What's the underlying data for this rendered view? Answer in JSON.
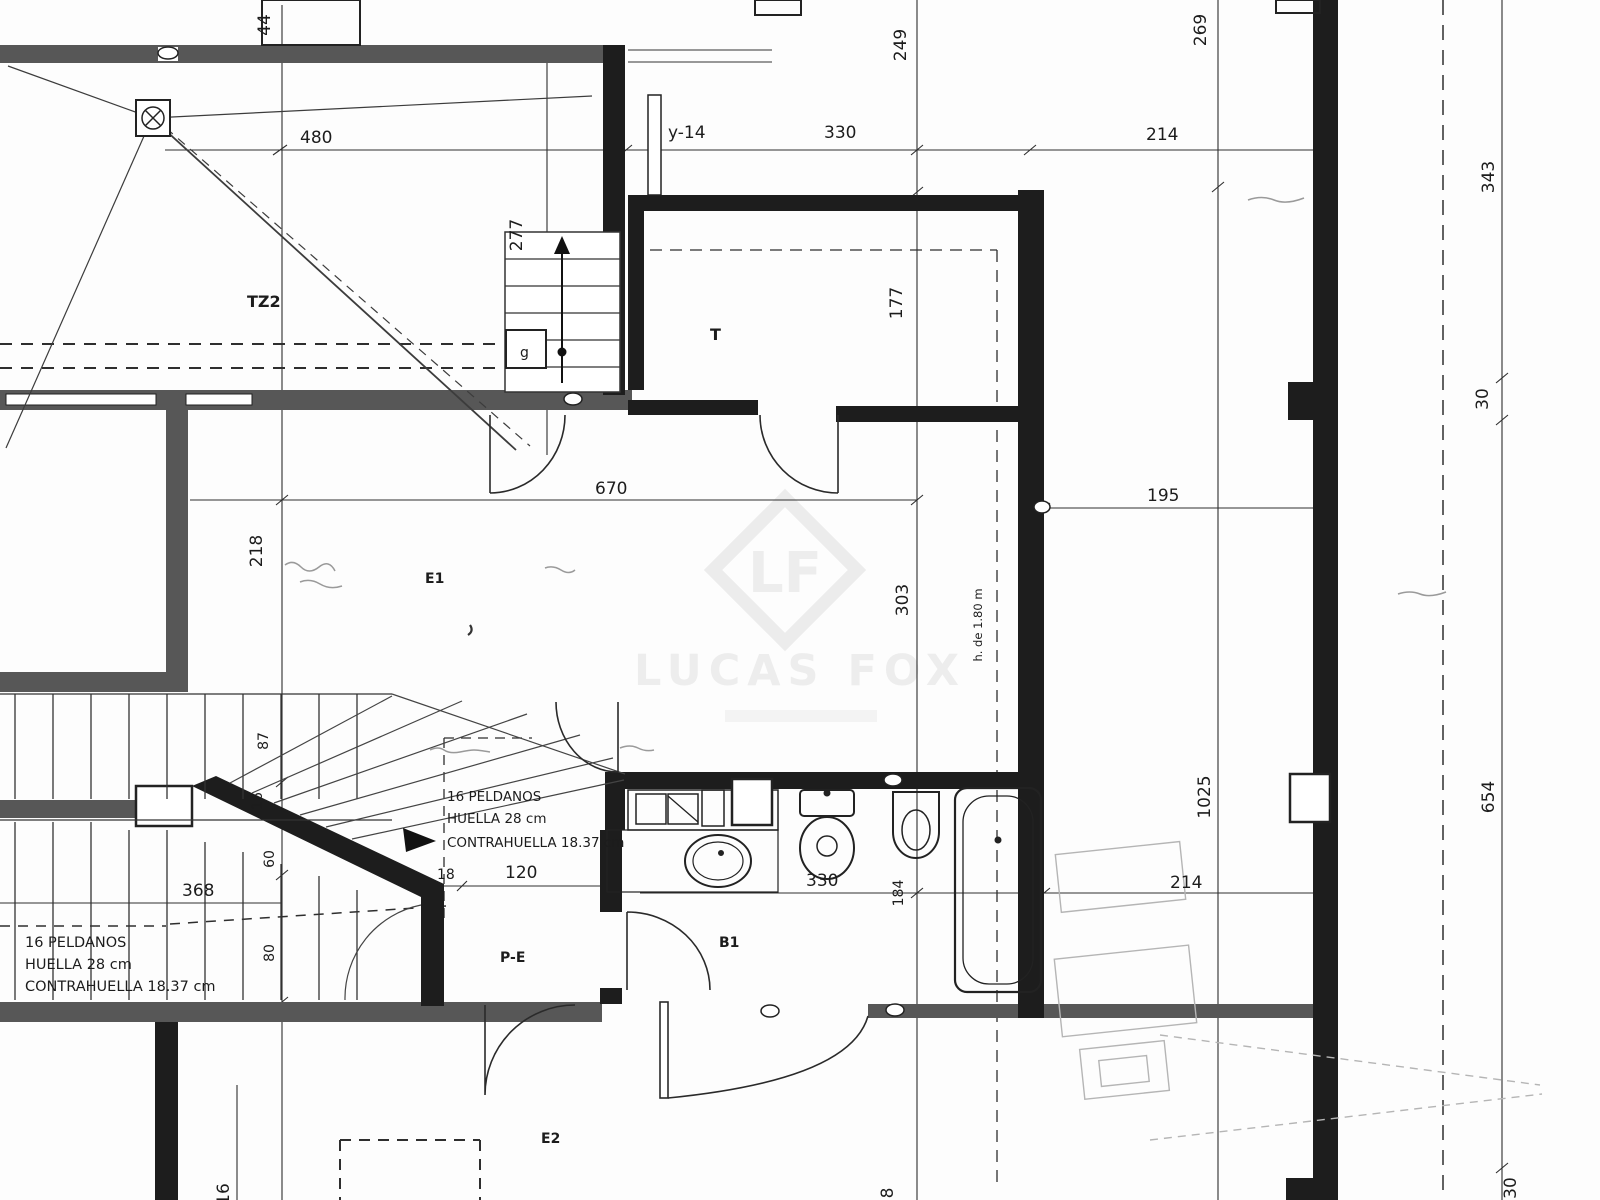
{
  "plan": {
    "rooms": {
      "tz2": "TZ2",
      "t": "T",
      "e1": "E1",
      "pe": "P-E",
      "b1": "B1",
      "e2": "E2"
    },
    "dims": {
      "d44": "44",
      "d480": "480",
      "d277": "277",
      "d249": "249",
      "d330_top": "330",
      "d214_top": "214",
      "d269": "269",
      "d343": "343",
      "d30_right": "30",
      "d177": "177",
      "d195": "195",
      "d670": "670",
      "d218": "218",
      "d303": "303",
      "d87": "87",
      "d16_mid": "16",
      "d60": "60",
      "d80": "80",
      "d368": "368",
      "d18": "18",
      "d120": "120",
      "d330_bath": "330",
      "d184": "184",
      "d1025": "1025",
      "d654": "654",
      "d214_bottom": "214",
      "d30_bottom": "30",
      "d16_bottom": "16",
      "d8_bottom": "8"
    },
    "annotations": {
      "y14": "y-14",
      "stair_left": [
        "16 PELDANOS",
        "HUELLA 28 cm",
        "CONTRAHUELLA 18.37 cm"
      ],
      "stair_right": [
        "16 PELDANOS",
        "HUELLA 28 cm",
        "CONTRAHUELLA 18.37 cm"
      ],
      "height_line": "h. de 1.80 m",
      "stair_box": "g"
    },
    "watermark": {
      "logo": "LF",
      "name": "LUCAS FOX"
    }
  }
}
